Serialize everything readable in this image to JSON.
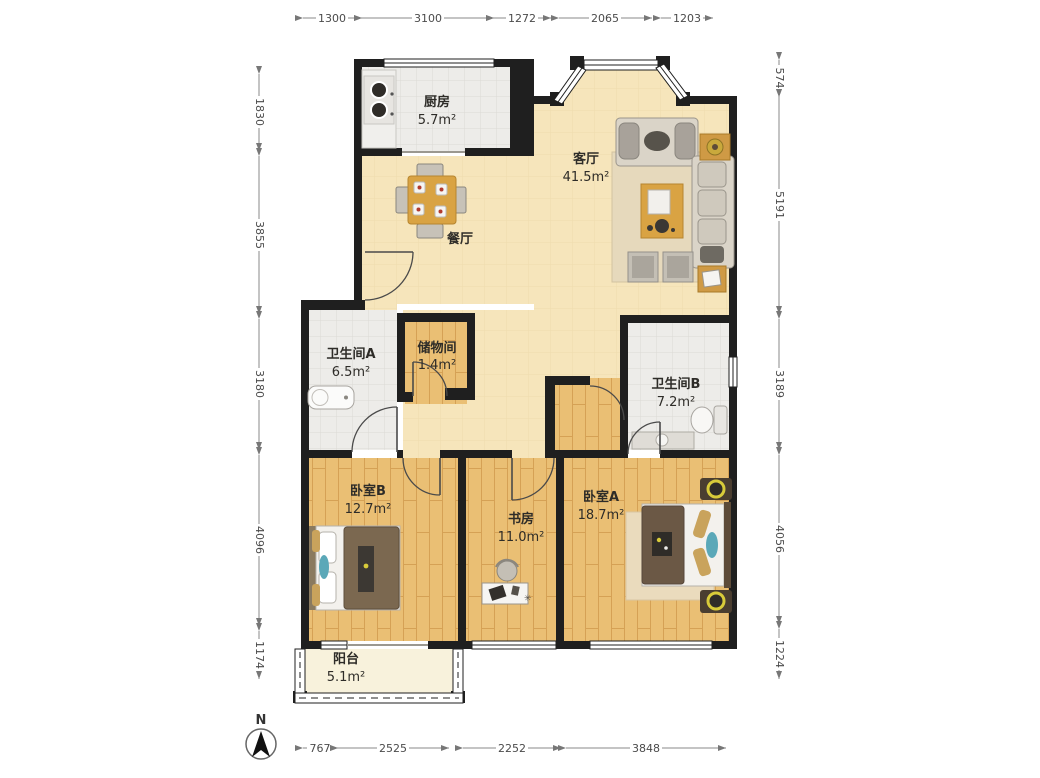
{
  "plan": {
    "compass_label": "N",
    "rooms": {
      "kitchen": {
        "name": "厨房",
        "area": "5.7m²"
      },
      "dining": {
        "name": "餐厅",
        "area": ""
      },
      "living": {
        "name": "客厅",
        "area": "41.5m²"
      },
      "bathroom_a": {
        "name": "卫生间A",
        "area": "6.5m²"
      },
      "storage": {
        "name": "储物间",
        "area": "1.4m²"
      },
      "bathroom_b": {
        "name": "卫生间B",
        "area": "7.2m²"
      },
      "bedroom_b": {
        "name": "卧室B",
        "area": "12.7m²"
      },
      "study": {
        "name": "书房",
        "area": "11.0m²"
      },
      "bedroom_a": {
        "name": "卧室A",
        "area": "18.7m²"
      },
      "balcony": {
        "name": "阳台",
        "area": "5.1m²"
      }
    },
    "dimensions_mm": {
      "top": [
        "1300",
        "3100",
        "1272",
        "2065",
        "1203"
      ],
      "left": [
        "1830",
        "3855",
        "3180",
        "4096",
        "1174"
      ],
      "right": [
        "574",
        "5191",
        "3189",
        "4056",
        "1224"
      ],
      "bottom": [
        "767",
        "2525",
        "2252",
        "3848"
      ]
    },
    "colors": {
      "wall": "#1f1f1f",
      "living_floor": "#f6e5bb",
      "wood_floor": "#eabf74",
      "tile_floor": "#edece9",
      "balcony_floor": "#f8f2dc",
      "accent_wood": "#d9a343"
    }
  }
}
